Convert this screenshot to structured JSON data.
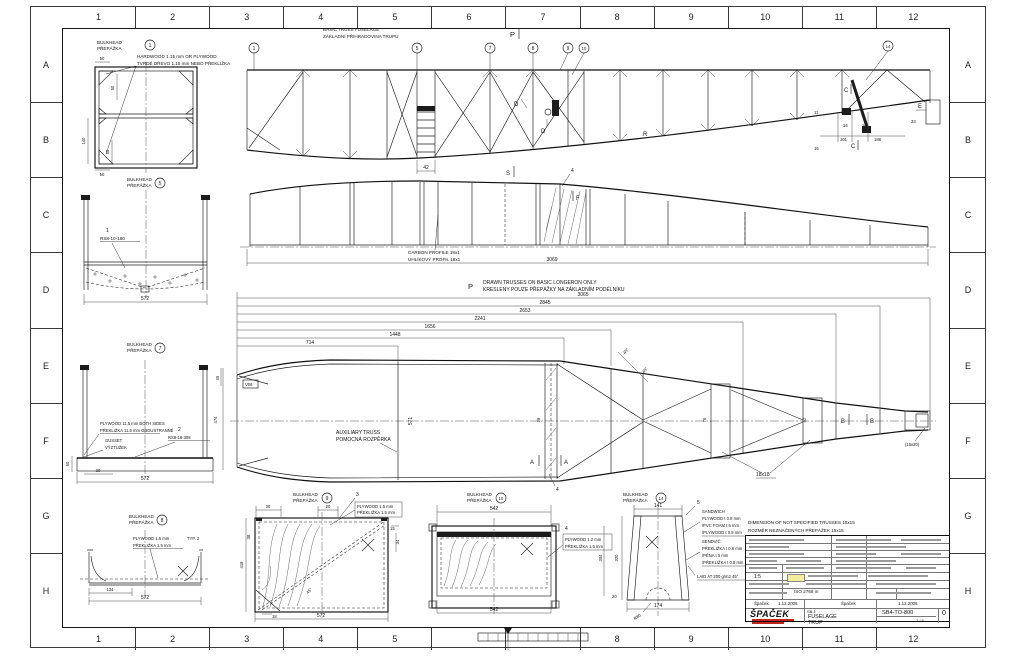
{
  "frame": {
    "cols": [
      "1",
      "2",
      "3",
      "4",
      "5",
      "6",
      "7",
      "8",
      "9",
      "10",
      "11",
      "12"
    ],
    "rows": [
      "A",
      "B",
      "C",
      "D",
      "E",
      "F",
      "G",
      "H"
    ]
  },
  "view1": {
    "title_en": "BASIC TRUSS FUSELAGE",
    "title_cz": "ZÁKLADNÍ PŘÍHRADOVINA TRUPU",
    "balloon_1": "1",
    "balloon_5": "5",
    "balloon_7": "7",
    "balloon_8": "8",
    "balloon_9": "9",
    "balloon_10": "10",
    "balloon_14": "14",
    "mark_p": "P",
    "mark_d": "D",
    "mark_s": "S",
    "mark_r": "R",
    "mark_e": "E",
    "mark_c": "C",
    "dim_11": "11",
    "dim_16": "16",
    "dim_101": "101",
    "dim_188": "188",
    "dim_33": "33",
    "dim_42": "42"
  },
  "view2": {
    "carbon_en": "CARBON PROFILE 18x1",
    "carbon_cz": "UHLÍKOVÝ PROFIL 18x1",
    "dim_3069": "3069",
    "mark_f": "F",
    "item_4": "4"
  },
  "view3": {
    "mark_p": "P",
    "note_en": "DRAWN TRUSSES ON BASIC LONGERON ONLY",
    "note_cz": "KRESLENY POUZE PŘEPÁŽKY NA ZÁKLADNÍM PODÉLNÍKU",
    "chain": [
      "3065",
      "2845",
      "2653",
      "2241",
      "1656",
      "1448",
      "714"
    ],
    "aux_en": "AUXILIARY TRUSS",
    "aux_cz": "POMOCNÁ ROZPĚRKA",
    "v06": "V06",
    "dim_571": "571",
    "dim_28": "28",
    "dim_76": "76",
    "dim_52": "52",
    "mark_a": "A",
    "mark_b": "B",
    "note_18": "18x18",
    "note_1520": "(15x20)",
    "angle_45": "45°",
    "item_4": "4"
  },
  "bulkhead": {
    "en": "BULKHEAD",
    "cz": "PŘEPÁŽKA"
  },
  "b1": {
    "num": "1",
    "note_en": "HARDWOOD 1.15 mm OR PLYWOOD",
    "note_cz": "TVRDÉ DŘEVO 1.15 mm NEBO PŘEKLIŽKA",
    "dim_50": "50",
    "dim_140": "140"
  },
  "b5": {
    "num": "5",
    "ref": "1",
    "part": "RS8-10-180",
    "dim_572": "572"
  },
  "b7": {
    "num": "7",
    "note_en": "PLYWOOD 11.5 mm BOTH SIDES",
    "note_cz": "PŘEKLIŽKA 11.5 mm OBOUSTRANNĚ",
    "gusset_en": "GUSSET",
    "gusset_cz": "VÝZTUŽEK",
    "ref": "2",
    "part": "RS8-18-308",
    "dim_45": "45",
    "dim_474": "474",
    "dim_60": "60",
    "dim_30": "30",
    "dim_572": "572"
  },
  "b8": {
    "num": "8",
    "note_en": "PLYWOOD 1.5 mm",
    "note_cz": "PŘEKLIŽKA 1.5 mm",
    "typ": "TYP. 2",
    "dim_134": "134",
    "dim_572": "572"
  },
  "b9": {
    "num": "9",
    "ref": "3",
    "note_en": "PLYWOOD 1.5 mm",
    "note_cz": "PŘEKLIŽKA 1.5 mm",
    "dim_30": "30",
    "dim_20": "20",
    "dim_15": "15",
    "dim_34": "34",
    "dim_38": "38",
    "dim_18": "18",
    "dim_418": "418",
    "dim_572": "572",
    "angle_45": "45°"
  },
  "b10": {
    "num": "10",
    "ref": "4",
    "note_en": "PLYWOOD 1.2 mm",
    "note_cz": "PŘEKLIŽKA 1.5 mm",
    "dim_542": "542",
    "dim_304": "304"
  },
  "b14": {
    "num": "14",
    "ref": "5",
    "dim_141": "141",
    "dim_174": "174",
    "dim_320": "320",
    "dim_20": "20",
    "r80": "R80",
    "sw_en_0": "SANDWICH",
    "sw_en_1": "PLYWOOD t 0.8 mm",
    "sw_en_2": "/PVC FOAM t 5 mm",
    "sw_en_3": "/PLYWOOD t 0.8 mm",
    "sw_cz_0": "SENDVIČ",
    "sw_cz_1": "PŘEKLIŽKA t 0.8 mm",
    "sw_cz_2": "/PĚNA t 5 mm",
    "sw_cz_3": "/PŘEKLIŽKA t 0.8 mm",
    "laid": "LAID AT 200 g/m2 45°"
  },
  "note15": {
    "en": "DIMENSION OF NOT SPECIFIED TRUSSES 15x15",
    "cz": "ROZMĚR NEZNAČENÝCH PŘEPÁŽEK 15x15"
  },
  "titleblock": {
    "tolerance": "ISO 2768 m",
    "scale": "1:5",
    "drawn_name": "Špaček",
    "drawn_date": "1.12.2006",
    "checked_name": "Špaček",
    "checked_date": "1.12.2006",
    "project": "SB-1",
    "title_en": "FUSELAGE",
    "title_cz": "TRUP",
    "number": "SB4-TO-800",
    "rev": "0",
    "sheet": "1 / 5",
    "company": "ŠPAČEK",
    "accent_yellow": "#f2ee9d",
    "accent_red": "#c0241c"
  }
}
